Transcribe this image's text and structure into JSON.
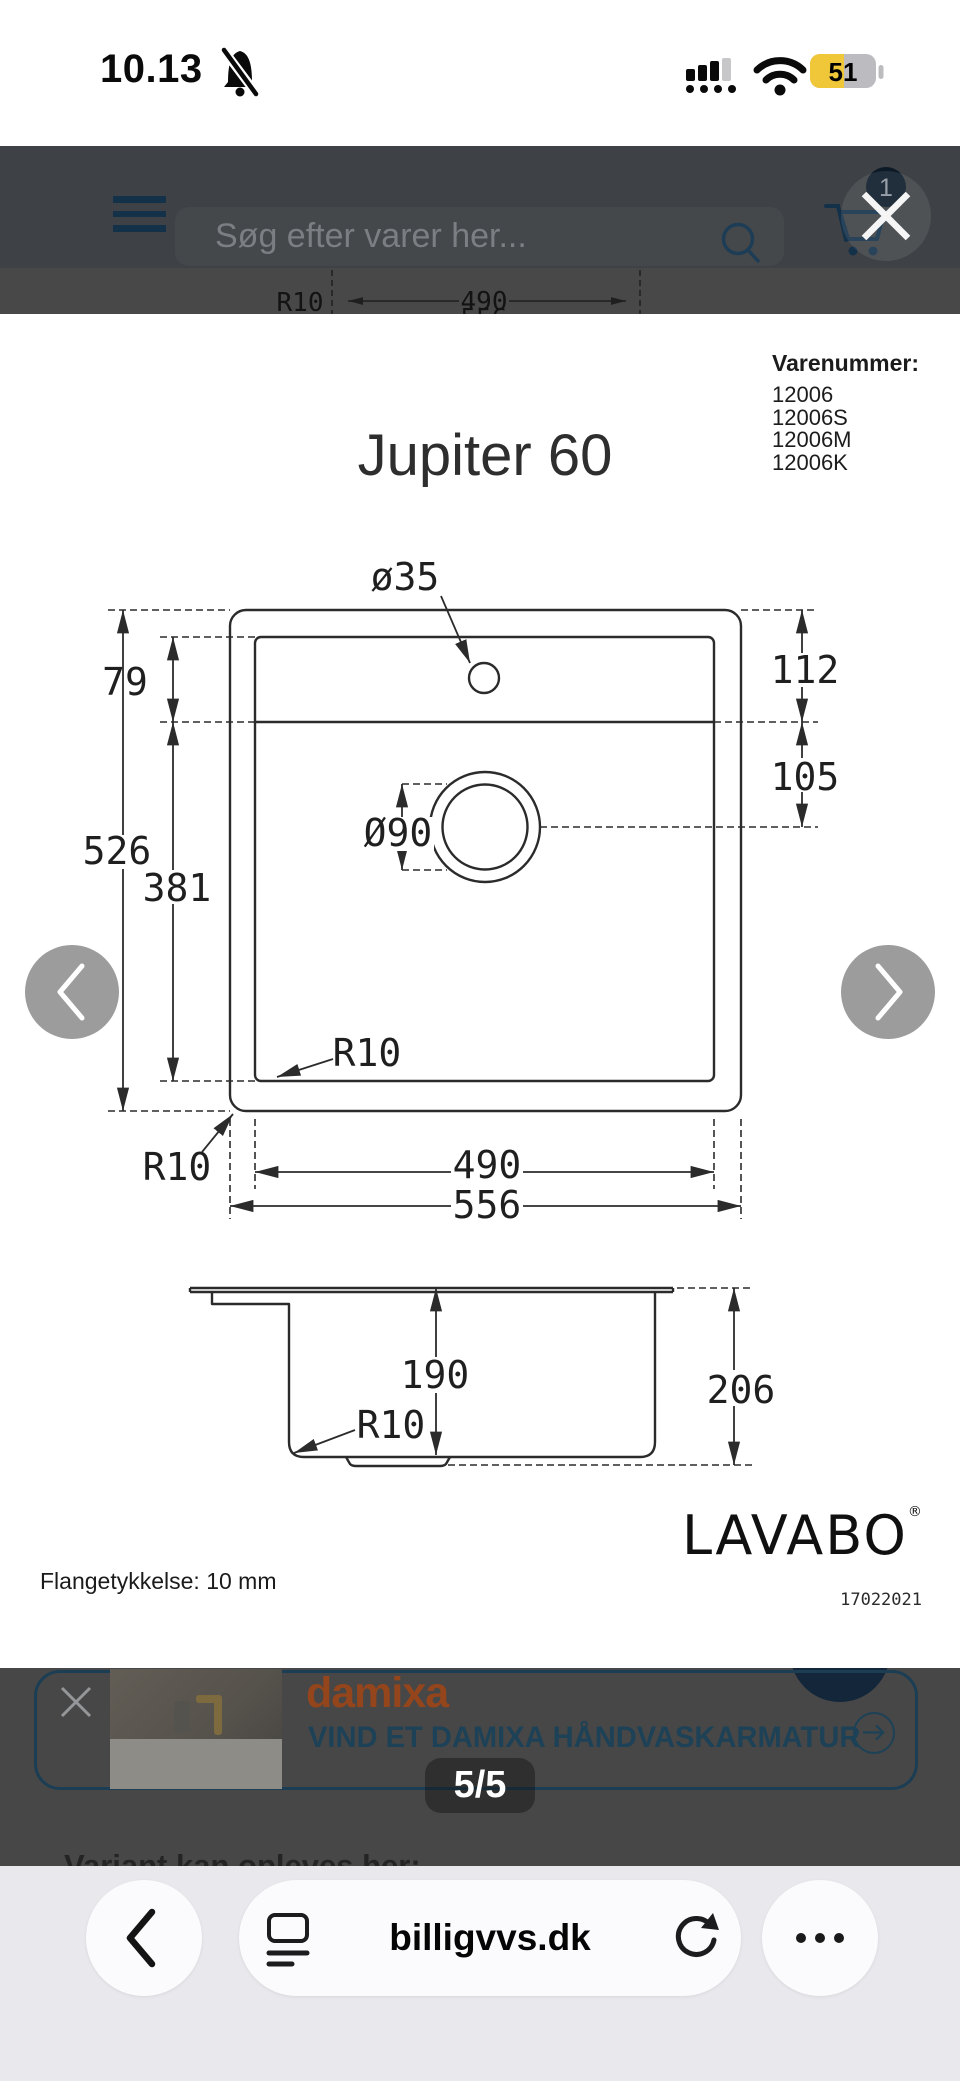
{
  "status_bar": {
    "time": "10.13",
    "battery": "51"
  },
  "header": {
    "search_placeholder": "Søg efter varer her...",
    "cart_count": "1"
  },
  "background_page": {
    "drawing_fragment": {
      "r10": "R10",
      "inner_width": "490",
      "outer_width": "556"
    },
    "promo": {
      "brand": "damixa",
      "headline": "VIND ET DAMIXA HÅNDVASKARMATUR"
    },
    "section_heading": "Variant kan opleves her:"
  },
  "lightbox": {
    "counter": "5/5",
    "sheet": {
      "varenummer_label": "Varenummer:",
      "varenummer": [
        "12006",
        "12006S",
        "12006M",
        "12006K"
      ],
      "title": "Jupiter 60",
      "brand": "LAVABO",
      "registered": "®",
      "note": "Flangetykkelse: 10 mm",
      "doc_number": "17022021",
      "drawing": {
        "top_view": {
          "tap_hole": "ø35",
          "deck_depth": "79",
          "right_upper": "112",
          "right_lower": "105",
          "drain": "Ø90",
          "outer_height": "526",
          "inner_height": "381",
          "radius_inner": "R10",
          "radius_outer": "R10",
          "inner_width": "490",
          "outer_width": "556"
        },
        "side_view": {
          "depth_inner": "190",
          "depth_outer": "206",
          "radius_bottom": "R10"
        }
      }
    }
  },
  "toolbar": {
    "url": "billigvvs.dk"
  },
  "colors": {
    "navy": "#1d4156",
    "header_bg": "#3e4145",
    "dim_bg": "#474747",
    "damixa_orange": "#94451c",
    "battery_yellow": "#f0c738",
    "arrow_gray": "#9c9c9c"
  }
}
